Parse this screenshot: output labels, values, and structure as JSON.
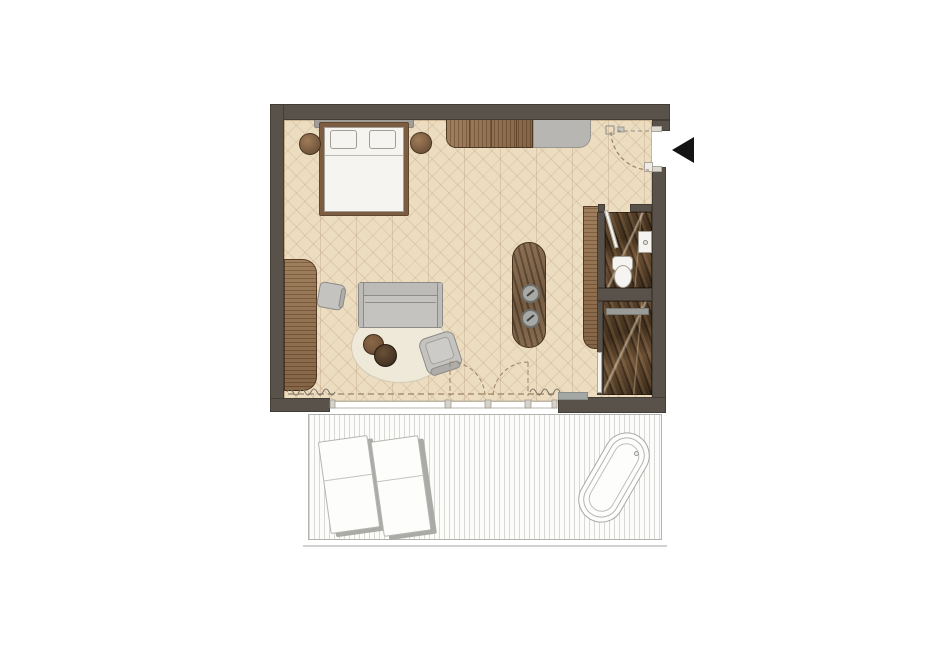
{
  "meta": {
    "title": "studio-suite-floor-plan",
    "visible_text": "none"
  },
  "colors": {
    "wall": "#58524a",
    "floor-base": "#ecdcc0",
    "wood": "#8b6a49",
    "marble-base": "#503d2c",
    "island-base": "#745c47",
    "gray-fill": "#c4c3bf",
    "gray-line": "#8c8b87",
    "bench-fill": "#b7b6b2",
    "white-fill": "#f5f4f0",
    "white-line": "#a39f96",
    "headboard": "#a19d97",
    "rug-fill": "#efe9da",
    "rug-line": "#d2c9b4",
    "deck-bg": "#fcfcfa",
    "deck-border": "#b2b2af",
    "dash": "#9b8266",
    "curtain": "#7a7365",
    "arrow": "#141414",
    "threshold": "#a4a8a5",
    "nightstand-light": "#a07c58",
    "nightstand-dark": "#59422d",
    "table-dark": "#4c3827",
    "table-light": "#77573c",
    "shadow": "#aaaaa7"
  },
  "plan": {
    "rooms": [
      {
        "name": "bedroom-living-area",
        "floor": "herringbone-parquet"
      },
      {
        "name": "wc",
        "floor": "dark-marble"
      },
      {
        "name": "shower-room",
        "floor": "dark-marble"
      },
      {
        "name": "terrace",
        "floor": "plank-decking"
      }
    ],
    "furniture": [
      "double-bed",
      "pillow-left",
      "pillow-right",
      "nightstand-left",
      "nightstand-right",
      "sideboard",
      "upholstered-bench",
      "desk",
      "desk-chair",
      "sofa",
      "round-rug",
      "coffee-table-small",
      "coffee-table-large",
      "armchair",
      "bar-island",
      "bar-stool-top",
      "bar-stool-bottom",
      "wardrobe-column",
      "toilet",
      "washbasin",
      "shower-bench",
      "shower-glass-door",
      "wc-door-leaf",
      "threshold",
      "sun-lounger-left",
      "sun-lounger-right",
      "outdoor-bathtub"
    ],
    "symbols": [
      "entrance-arrow",
      "entry-door-swing-arc",
      "double-door-swing-arcs",
      "sliding-glass-wall-dashed-line",
      "curtain-squiggle-left",
      "curtain-squiggle-right",
      "electrical-symbols",
      "window-track-with-mullions",
      "deck-outer-line"
    ]
  }
}
